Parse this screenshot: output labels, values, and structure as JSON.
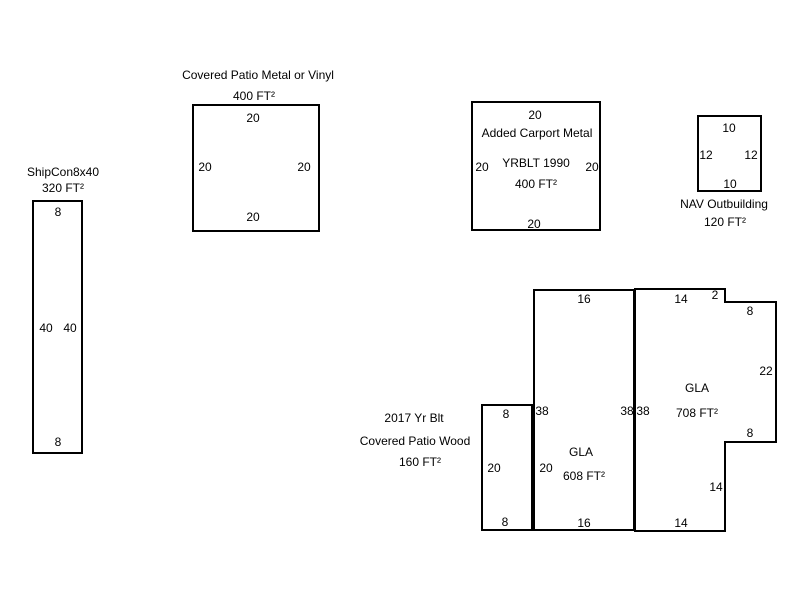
{
  "canvas": {
    "width": 800,
    "height": 600,
    "background": "#ffffff",
    "line_color": "#000000",
    "text_color": "#000000"
  },
  "shapes": [
    {
      "name": "shipcon-8x40",
      "type": "rect",
      "rect": {
        "x": 32,
        "y": 200,
        "w": 51,
        "h": 254
      },
      "titles": [
        {
          "text": "ShipCon8x40",
          "x": 63,
          "y": 172
        },
        {
          "text": "320 FT²",
          "x": 63,
          "y": 188
        }
      ],
      "labels": [
        {
          "text": "8",
          "x": 58,
          "y": 212
        },
        {
          "text": "40",
          "x": 46,
          "y": 328
        },
        {
          "text": "40",
          "x": 70,
          "y": 328
        },
        {
          "text": "8",
          "x": 58,
          "y": 442
        }
      ]
    },
    {
      "name": "covered-patio-metal-or-vinyl",
      "type": "rect",
      "rect": {
        "x": 192,
        "y": 104,
        "w": 128,
        "h": 128
      },
      "titles": [
        {
          "text": "Covered Patio Metal or Vinyl",
          "x": 258,
          "y": 75
        },
        {
          "text": "400 FT²",
          "x": 254,
          "y": 96
        }
      ],
      "labels": [
        {
          "text": "20",
          "x": 253,
          "y": 118
        },
        {
          "text": "20",
          "x": 205,
          "y": 167
        },
        {
          "text": "20",
          "x": 304,
          "y": 167
        },
        {
          "text": "20",
          "x": 253,
          "y": 217
        }
      ]
    },
    {
      "name": "added-carport-metal",
      "type": "rect",
      "rect": {
        "x": 471,
        "y": 101,
        "w": 130,
        "h": 130
      },
      "titles": [],
      "labels": [
        {
          "text": "20",
          "x": 535,
          "y": 115
        },
        {
          "text": "Added Carport Metal",
          "x": 537,
          "y": 133
        },
        {
          "text": "20",
          "x": 482,
          "y": 167
        },
        {
          "text": "YRBLT 1990",
          "x": 536,
          "y": 163
        },
        {
          "text": "20",
          "x": 592,
          "y": 167
        },
        {
          "text": "400 FT²",
          "x": 536,
          "y": 184
        },
        {
          "text": "20",
          "x": 534,
          "y": 224
        }
      ]
    },
    {
      "name": "nav-outbuilding",
      "type": "rect",
      "rect": {
        "x": 697,
        "y": 115,
        "w": 65,
        "h": 77
      },
      "titles": [
        {
          "text": "NAV Outbuilding",
          "x": 724,
          "y": 204
        },
        {
          "text": "120 FT²",
          "x": 725,
          "y": 222
        }
      ],
      "labels": [
        {
          "text": "10",
          "x": 729,
          "y": 128
        },
        {
          "text": "12",
          "x": 706,
          "y": 155
        },
        {
          "text": "12",
          "x": 751,
          "y": 155
        },
        {
          "text": "10",
          "x": 730,
          "y": 184
        }
      ]
    },
    {
      "name": "covered-patio-wood",
      "type": "rect",
      "rect": {
        "x": 481,
        "y": 404,
        "w": 52,
        "h": 127
      },
      "titles": [
        {
          "text": "2017 Yr Blt",
          "x": 414,
          "y": 418
        },
        {
          "text": "Covered Patio Wood",
          "x": 415,
          "y": 441
        },
        {
          "text": "160 FT²",
          "x": 420,
          "y": 462
        }
      ],
      "labels": [
        {
          "text": "8",
          "x": 506,
          "y": 414
        },
        {
          "text": "20",
          "x": 494,
          "y": 468
        },
        {
          "text": "8",
          "x": 505,
          "y": 522
        }
      ]
    },
    {
      "name": "gla-608",
      "type": "rect",
      "rect": {
        "x": 533,
        "y": 289,
        "w": 102,
        "h": 242
      },
      "titles": [],
      "labels": [
        {
          "text": "16",
          "x": 584,
          "y": 299
        },
        {
          "text": "38",
          "x": 542,
          "y": 411
        },
        {
          "text": "38",
          "x": 627,
          "y": 411
        },
        {
          "text": "GLA",
          "x": 581,
          "y": 452
        },
        {
          "text": "20",
          "x": 546,
          "y": 468
        },
        {
          "text": "608 FT²",
          "x": 584,
          "y": 476
        },
        {
          "text": "16",
          "x": 584,
          "y": 523
        }
      ]
    },
    {
      "name": "gla-708",
      "type": "polygon",
      "points": [
        [
          635,
          289
        ],
        [
          725,
          289
        ],
        [
          725,
          302
        ],
        [
          776,
          302
        ],
        [
          776,
          442
        ],
        [
          725,
          442
        ],
        [
          725,
          531
        ],
        [
          635,
          531
        ]
      ],
      "titles": [],
      "labels": [
        {
          "text": "14",
          "x": 681,
          "y": 299
        },
        {
          "text": "2",
          "x": 715,
          "y": 295
        },
        {
          "text": "8",
          "x": 750,
          "y": 311
        },
        {
          "text": "22",
          "x": 766,
          "y": 371
        },
        {
          "text": "GLA",
          "x": 697,
          "y": 388
        },
        {
          "text": "38",
          "x": 643,
          "y": 411
        },
        {
          "text": "708 FT²",
          "x": 697,
          "y": 413
        },
        {
          "text": "8",
          "x": 750,
          "y": 433
        },
        {
          "text": "14",
          "x": 716,
          "y": 487
        },
        {
          "text": "14",
          "x": 681,
          "y": 523
        }
      ]
    }
  ]
}
